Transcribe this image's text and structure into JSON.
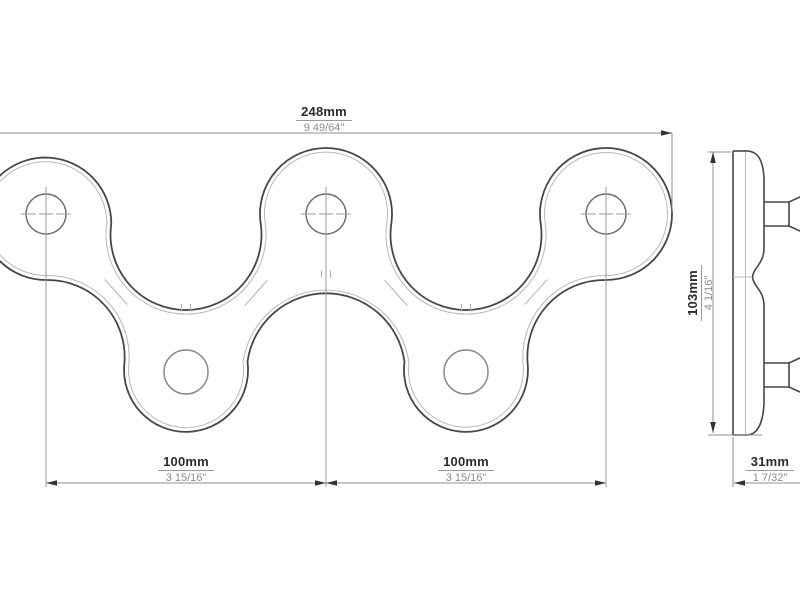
{
  "drawing": {
    "type": "technical-orthographic-drawing",
    "subject": "wave-shaped wall rack plate with two pegs, front view and side view",
    "colors": {
      "background": "#ffffff",
      "outline": "#474747",
      "thin_edge": "#b8b8b8",
      "dimension_line": "#8f8f8f",
      "arrow": "#333333",
      "text_primary": "#2b2b2b",
      "text_secondary": "#8d8d8d"
    },
    "front_view": {
      "top_holes_count": 3,
      "bottom_holes_count": 2,
      "dim_total_width": {
        "mm": "248mm",
        "inch": "9 49/64\""
      },
      "dim_spacing_left": {
        "mm": "100mm",
        "inch": "3 15/16\""
      },
      "dim_spacing_right": {
        "mm": "100mm",
        "inch": "3 15/16\""
      }
    },
    "side_view": {
      "pegs_count": 2,
      "dim_height": {
        "mm": "103mm",
        "inch": "4 1/16\""
      },
      "dim_depth": {
        "mm": "31mm",
        "inch": "1 7/32\""
      }
    }
  }
}
